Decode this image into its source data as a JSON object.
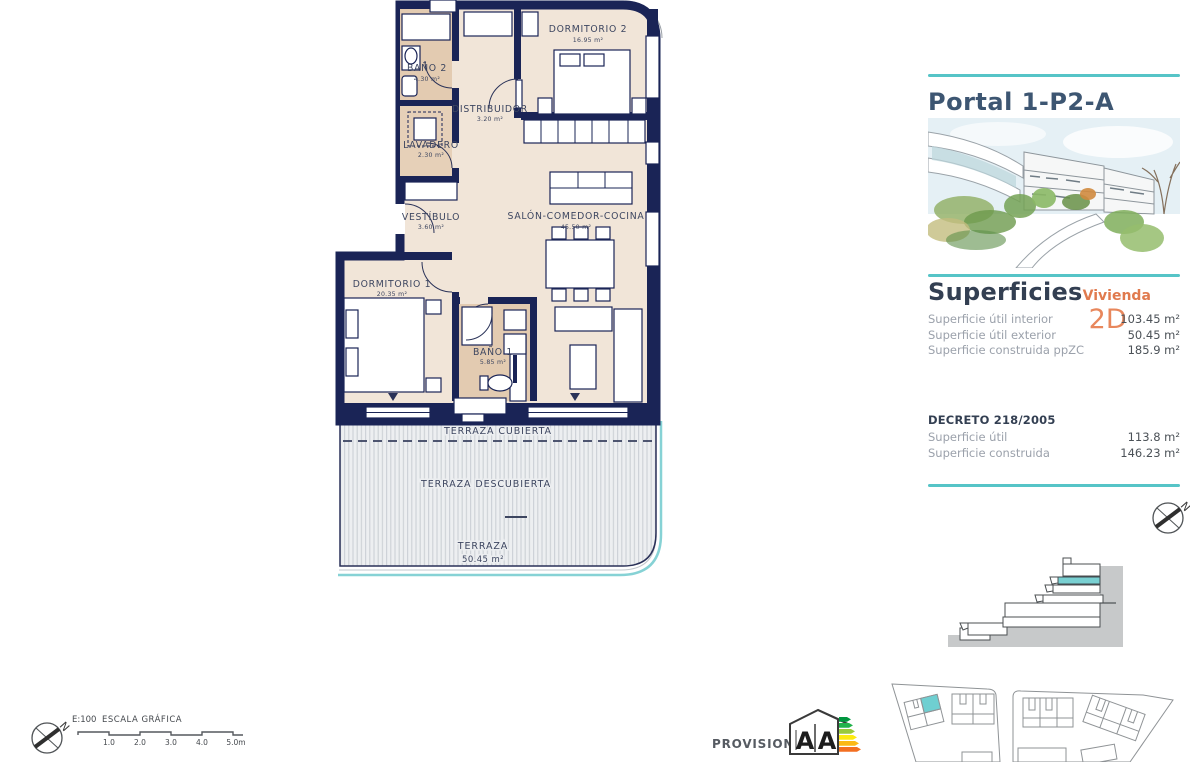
{
  "panel": {
    "title": "Portal 1-P2-A",
    "superficies": {
      "heading": "Superficies",
      "vivienda_label": "Vivienda",
      "unit": "2D",
      "rows": [
        {
          "label": "Superficie útil interior",
          "value": "103.45 m²"
        },
        {
          "label": "Superficie útil exterior",
          "value": "50.45 m²"
        },
        {
          "label": "Superficie construida ppZC",
          "value": "185.9 m²"
        }
      ]
    },
    "decreto": {
      "heading": "DECRETO 218/2005",
      "rows": [
        {
          "label": "Superficie útil",
          "value": "113.8 m²"
        },
        {
          "label": "Superficie construida",
          "value": "146.23 m²"
        }
      ]
    }
  },
  "plan": {
    "rooms": [
      {
        "name": "DORMITORIO 2",
        "area": "16.95 m²"
      },
      {
        "name": "BAÑO 2",
        "area": "4.30 m²"
      },
      {
        "name": "DISTRIBUIDOR",
        "area": "3.20 m²"
      },
      {
        "name": "LAVADERO",
        "area": "2.30 m²"
      },
      {
        "name": "VESTÍBULO",
        "area": "3.60 m²"
      },
      {
        "name": "SALÓN-COMEDOR-COCINA",
        "area": "45.50 m²"
      },
      {
        "name": "DORMITORIO 1",
        "area": "20.35 m²"
      },
      {
        "name": "BAÑO 1",
        "area": "5.85 m²"
      }
    ],
    "terrace": {
      "covered": "TERRAZA CUBIERTA",
      "uncovered": "TERRAZA DESCUBIERTA",
      "name": "TERRAZA",
      "area": "50.45 m²"
    }
  },
  "footer": {
    "scale_ratio": "E:100",
    "scale_label": "ESCALA GRÁFICA",
    "scale_ticks": [
      "1.0",
      "2.0",
      "3.0",
      "4.0",
      "5.0m"
    ],
    "provisional": "PROVISIONAL"
  },
  "energy": {
    "letter_left": "A",
    "letter_right": "A"
  },
  "compass": {
    "north": "N"
  },
  "colors": {
    "wall": "#1a2456",
    "teal": "#56c4c7",
    "orange": "#e07a4e",
    "highlight": "#79d0d2"
  }
}
